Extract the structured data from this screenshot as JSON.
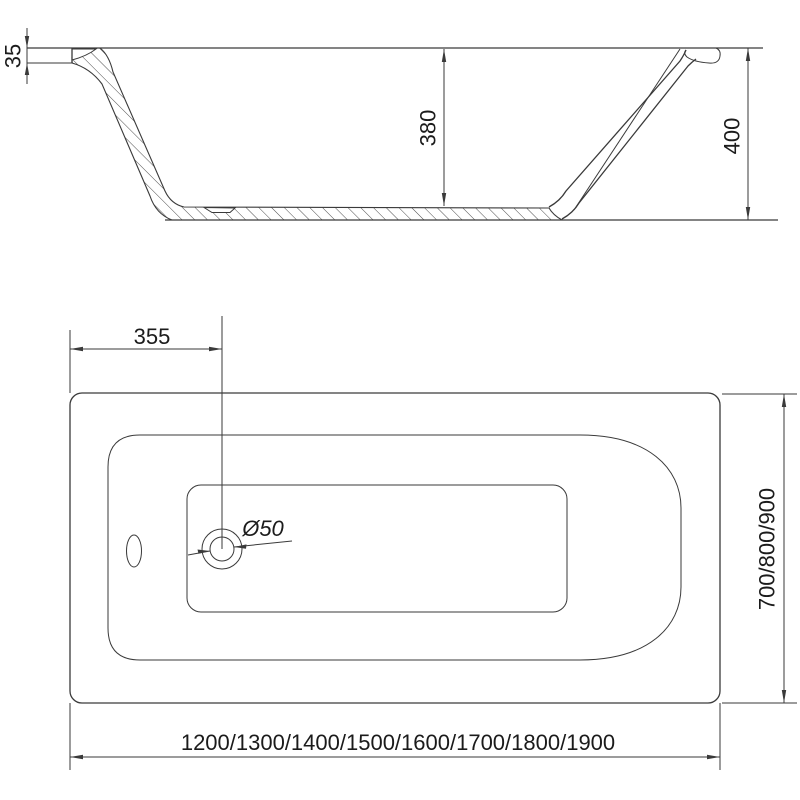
{
  "drawing": {
    "title": "bathtub-technical-drawing",
    "side_view": {
      "rim_edge_drop_mm": "35",
      "inner_depth_mm": "380",
      "overall_height_mm": "400"
    },
    "plan_view": {
      "drain_offset_mm": "355",
      "drain_diameter": "Ø50",
      "width_options_mm": "700/800/900",
      "length_options_mm": "1200/1300/1400/1500/1600/1700/1800/1900"
    }
  },
  "colors": {
    "line": "#3a3a3a",
    "text": "#1b1b1b",
    "background": "#ffffff"
  }
}
